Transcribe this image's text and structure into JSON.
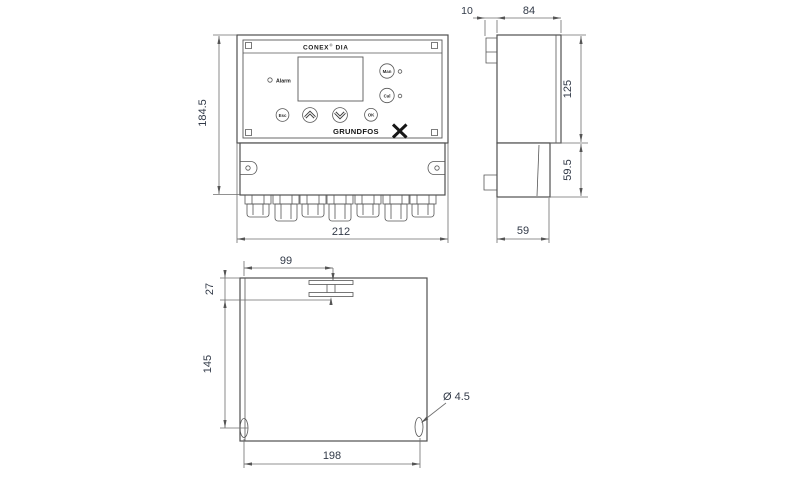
{
  "front_view": {
    "title_brand": "CONEX",
    "title_reg": "®",
    "title_model": "DIA",
    "alarm_label": "Alarm",
    "btn_man": "Man",
    "btn_cal": "Cal",
    "btn_esc": "Esc",
    "btn_ok": "OK",
    "logo_text": "GRUNDFOS",
    "dim_height": "184.5",
    "dim_width": "212"
  },
  "side_view": {
    "dim_plate_offset": "10",
    "dim_depth": "84",
    "dim_upper_height": "125",
    "dim_lower_height": "59.5",
    "dim_lower_depth": "59"
  },
  "back_view": {
    "dim_slot_x": "99",
    "dim_slot_y": "27",
    "dim_holes_y": "145",
    "dim_holes_x": "198",
    "hole_dia": "Ø 4.5"
  },
  "colors": {
    "line": "#4f4f4f",
    "dim_line": "#6e6e6e",
    "dim_text": "#323a48"
  }
}
